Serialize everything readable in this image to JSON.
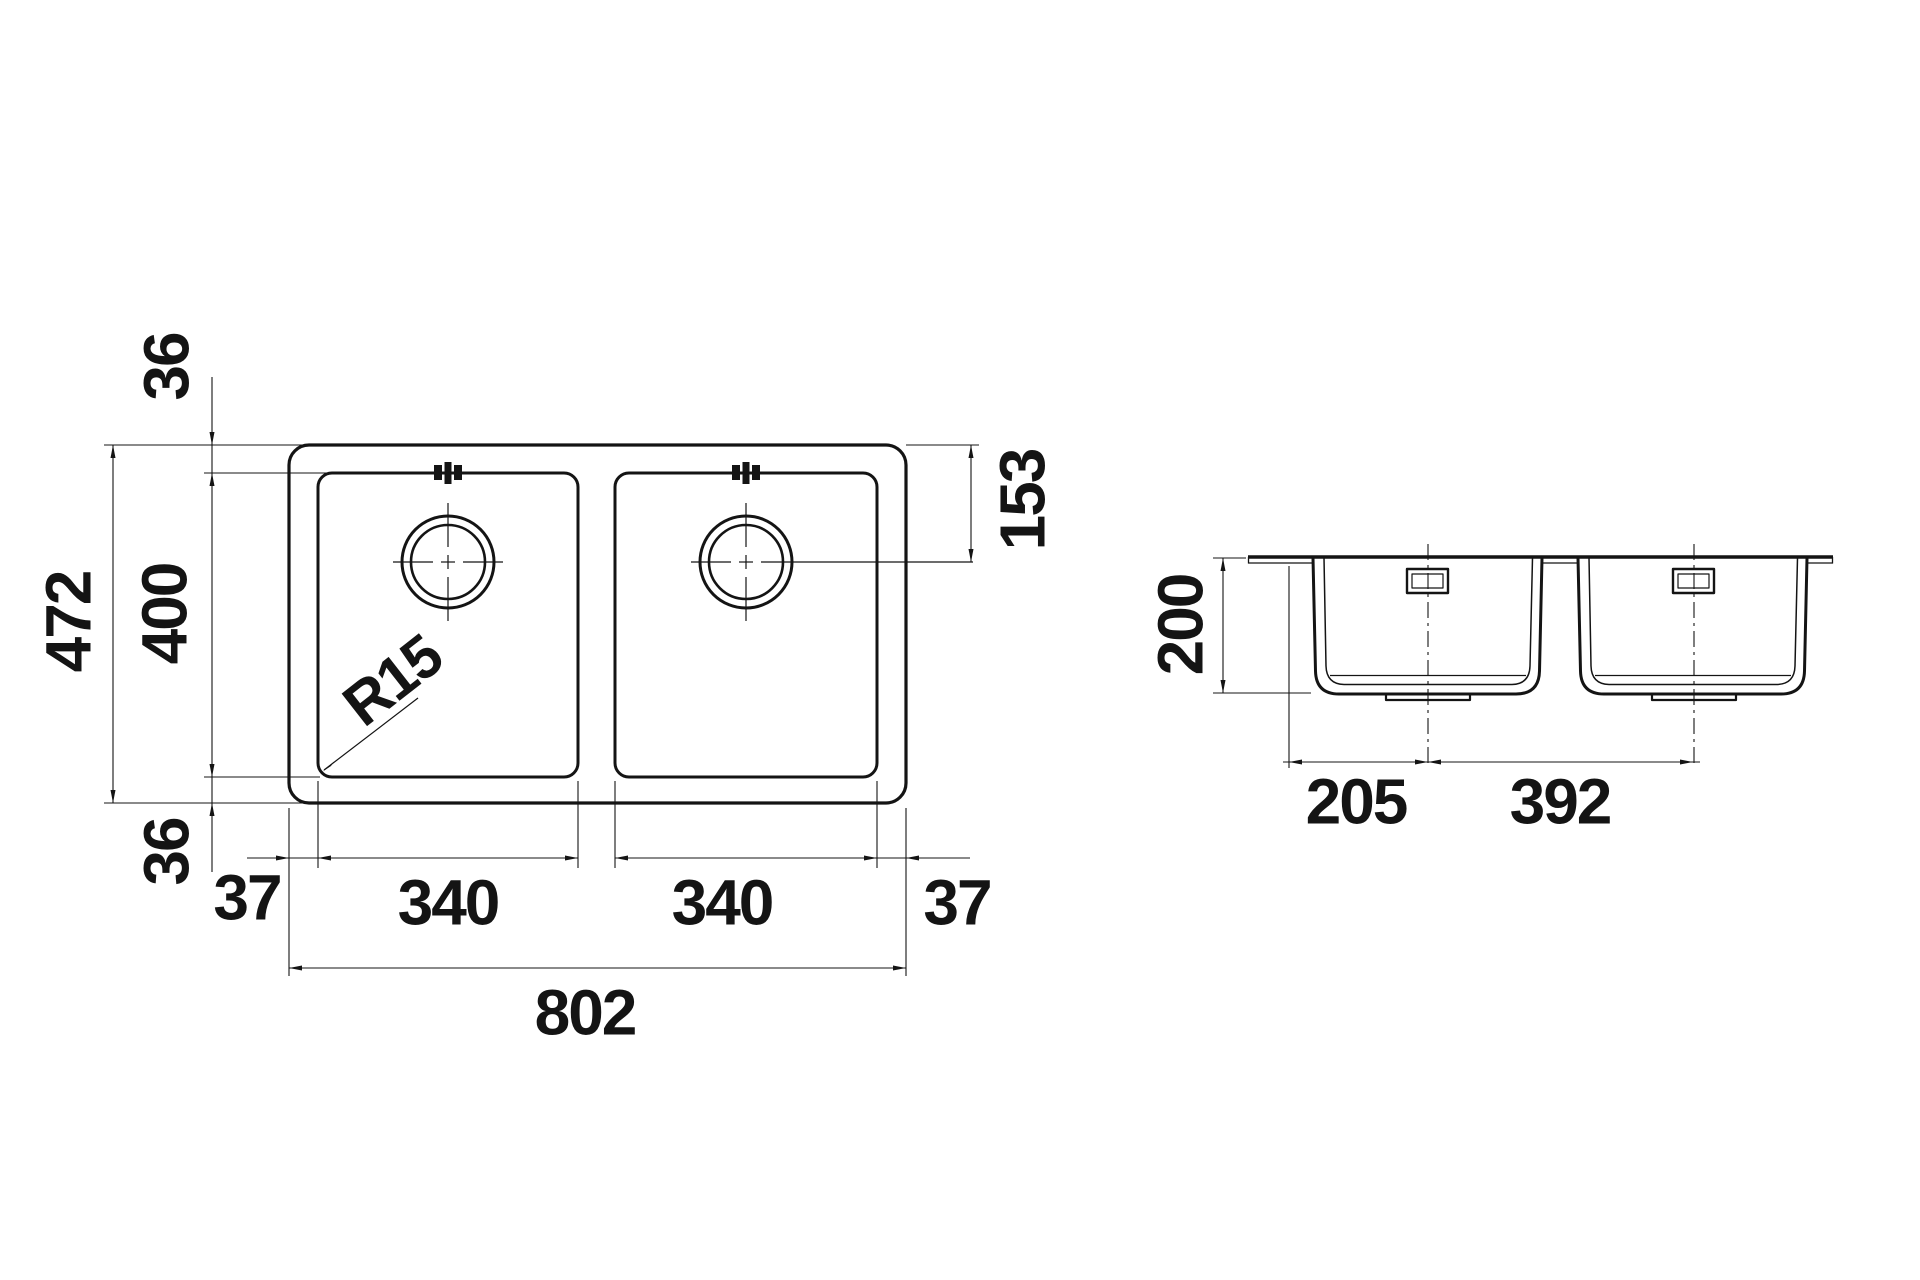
{
  "canvas": {
    "background": "#ffffff",
    "line_color": "#141414"
  },
  "top_view": {
    "overall_width": "802",
    "overall_depth": "472",
    "bowl_cutout_depth": "400",
    "top_margin": "36",
    "bottom_margin": "36",
    "left_margin": "37",
    "right_margin": "37",
    "left_bowl_width": "340",
    "right_bowl_width": "340",
    "drain_offset_from_top_edge": "153",
    "corner_radius": "R15"
  },
  "side_view": {
    "bowl_depth": "200",
    "edge_to_first_drain_center": "205",
    "drain_center_spacing": "392"
  }
}
